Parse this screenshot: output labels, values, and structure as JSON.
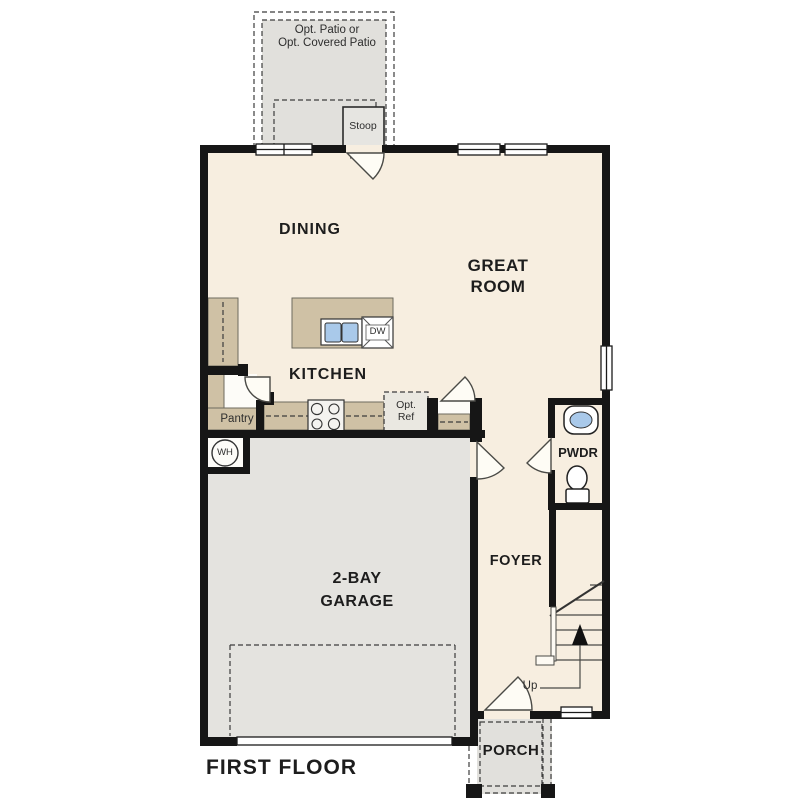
{
  "plan": {
    "floor_title": "FIRST FLOOR",
    "rooms": {
      "dining": "DINING",
      "great_room": [
        "GREAT",
        "ROOM"
      ],
      "kitchen": "KITCHEN",
      "garage": [
        "2-BAY",
        "GARAGE"
      ],
      "foyer": "FOYER",
      "powder_room": "PWDR",
      "porch": "PORCH"
    },
    "features": {
      "optional_patio": [
        "Opt. Patio or",
        "Opt. Covered Patio"
      ],
      "stoop": "Stoop",
      "pantry": "Pantry",
      "optional_refrigerator": [
        "Opt.",
        "Ref"
      ],
      "water_heater": "WH",
      "dishwasher": "DW",
      "stairs_direction": "Up"
    },
    "colors": {
      "interior": "#f7eee0",
      "garage": "#e4e3df",
      "patio": "#e1e0dc",
      "counters": "#cfc1a5",
      "walls": "#161616",
      "sink_blue": "#a9c9ea",
      "line": "#3c3c3c"
    }
  }
}
